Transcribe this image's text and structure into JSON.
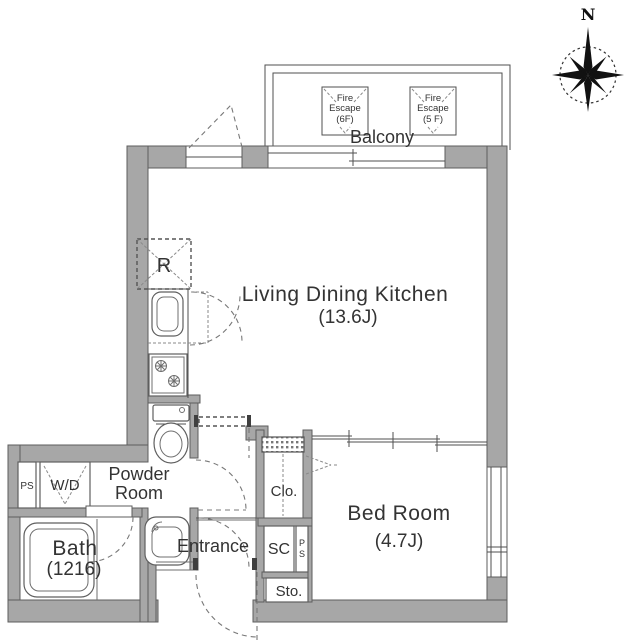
{
  "title": "apartment-floor-plan",
  "colors": {
    "wall_fill": "#a7a7a7",
    "wall_edge": "#5d5d5d",
    "line": "#4f4f4f",
    "text": "#333333",
    "background": "#ffffff"
  },
  "compass": {
    "north_label": "N"
  },
  "balcony": {
    "label": "Balcony",
    "fire_escape_6f": {
      "l1": "Fire",
      "l2": "Escape",
      "l3": "(6F)"
    },
    "fire_escape_5f": {
      "l1": "Fire",
      "l2": "Escape",
      "l3": "(5 F)"
    }
  },
  "rooms": {
    "ldk": {
      "name": "Living Dining Kitchen",
      "size": "(13.6J)"
    },
    "bedroom": {
      "name": "Bed Room",
      "size": "(4.7J)"
    },
    "bath": {
      "name": "Bath",
      "size": "(1216)"
    },
    "powder_room": {
      "line1": "Powder",
      "line2": "Room"
    },
    "entrance": {
      "name": "Entrance"
    },
    "closet": {
      "name": "Clo."
    },
    "shoe_closet": {
      "name": "SC"
    },
    "storage": {
      "name": "Sto."
    },
    "pipe_shaft": {
      "name": "PS"
    },
    "pipe_shaft_narrow": {
      "p": "P",
      "s": "S"
    },
    "washer_dryer": {
      "name": "W/D"
    },
    "refrigerator": {
      "name": "R"
    }
  }
}
